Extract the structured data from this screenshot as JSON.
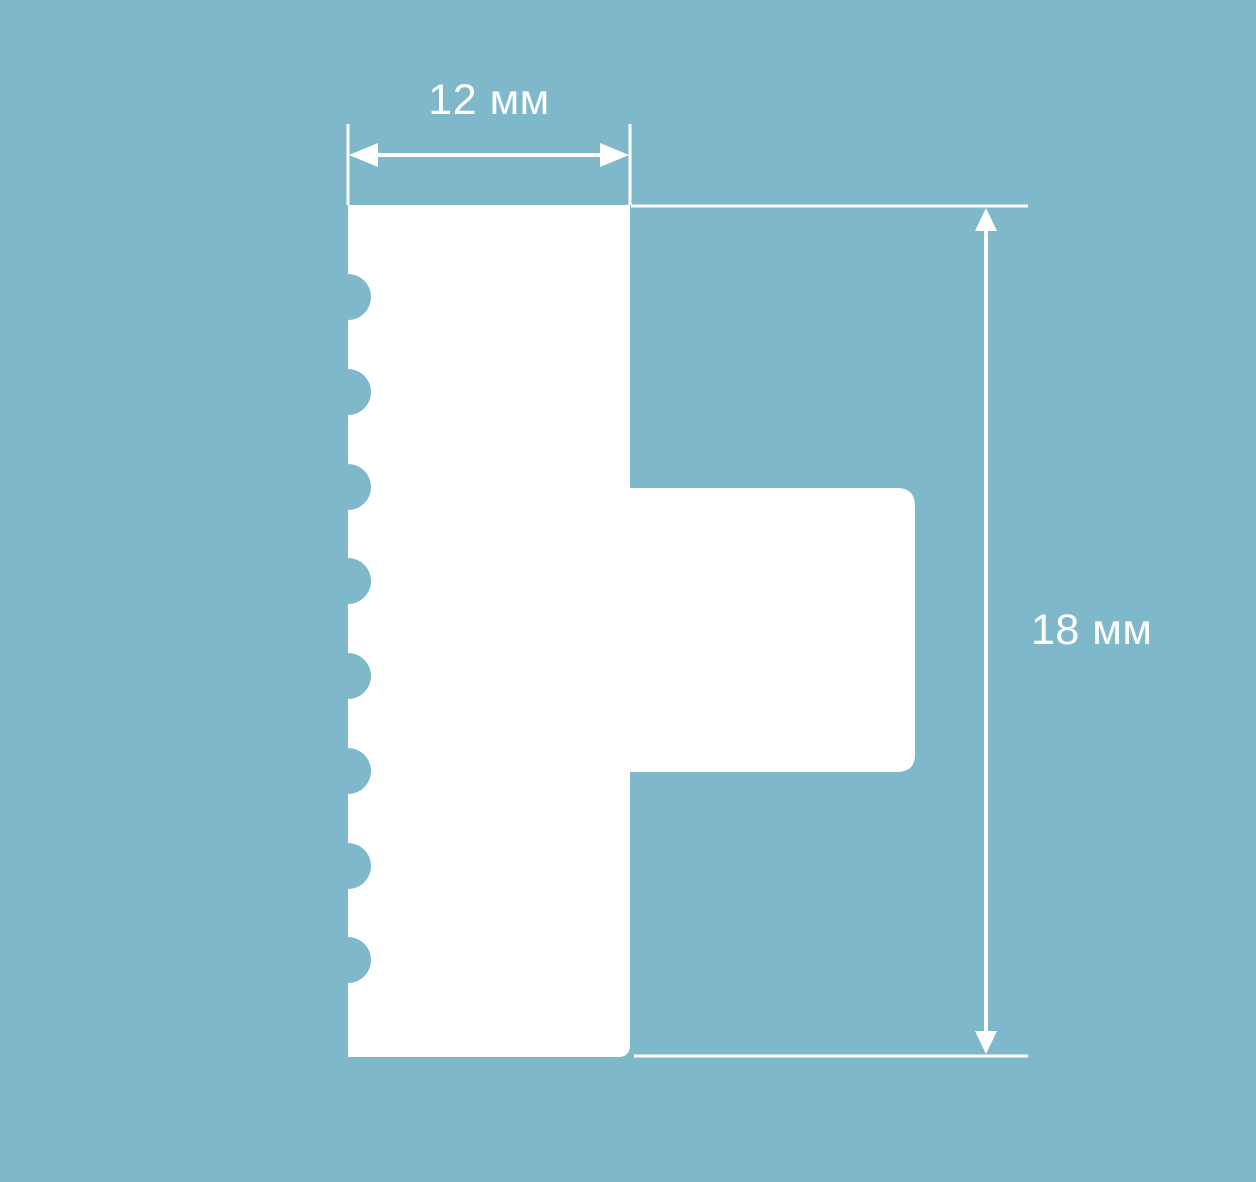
{
  "diagram": {
    "width_label": "12 мм",
    "height_label": "18 мм"
  },
  "colors": {
    "background": "#7fb8ca",
    "shape": "#ffffff",
    "dimension_lines": "#ffffff",
    "label_text": "#ffffff"
  }
}
